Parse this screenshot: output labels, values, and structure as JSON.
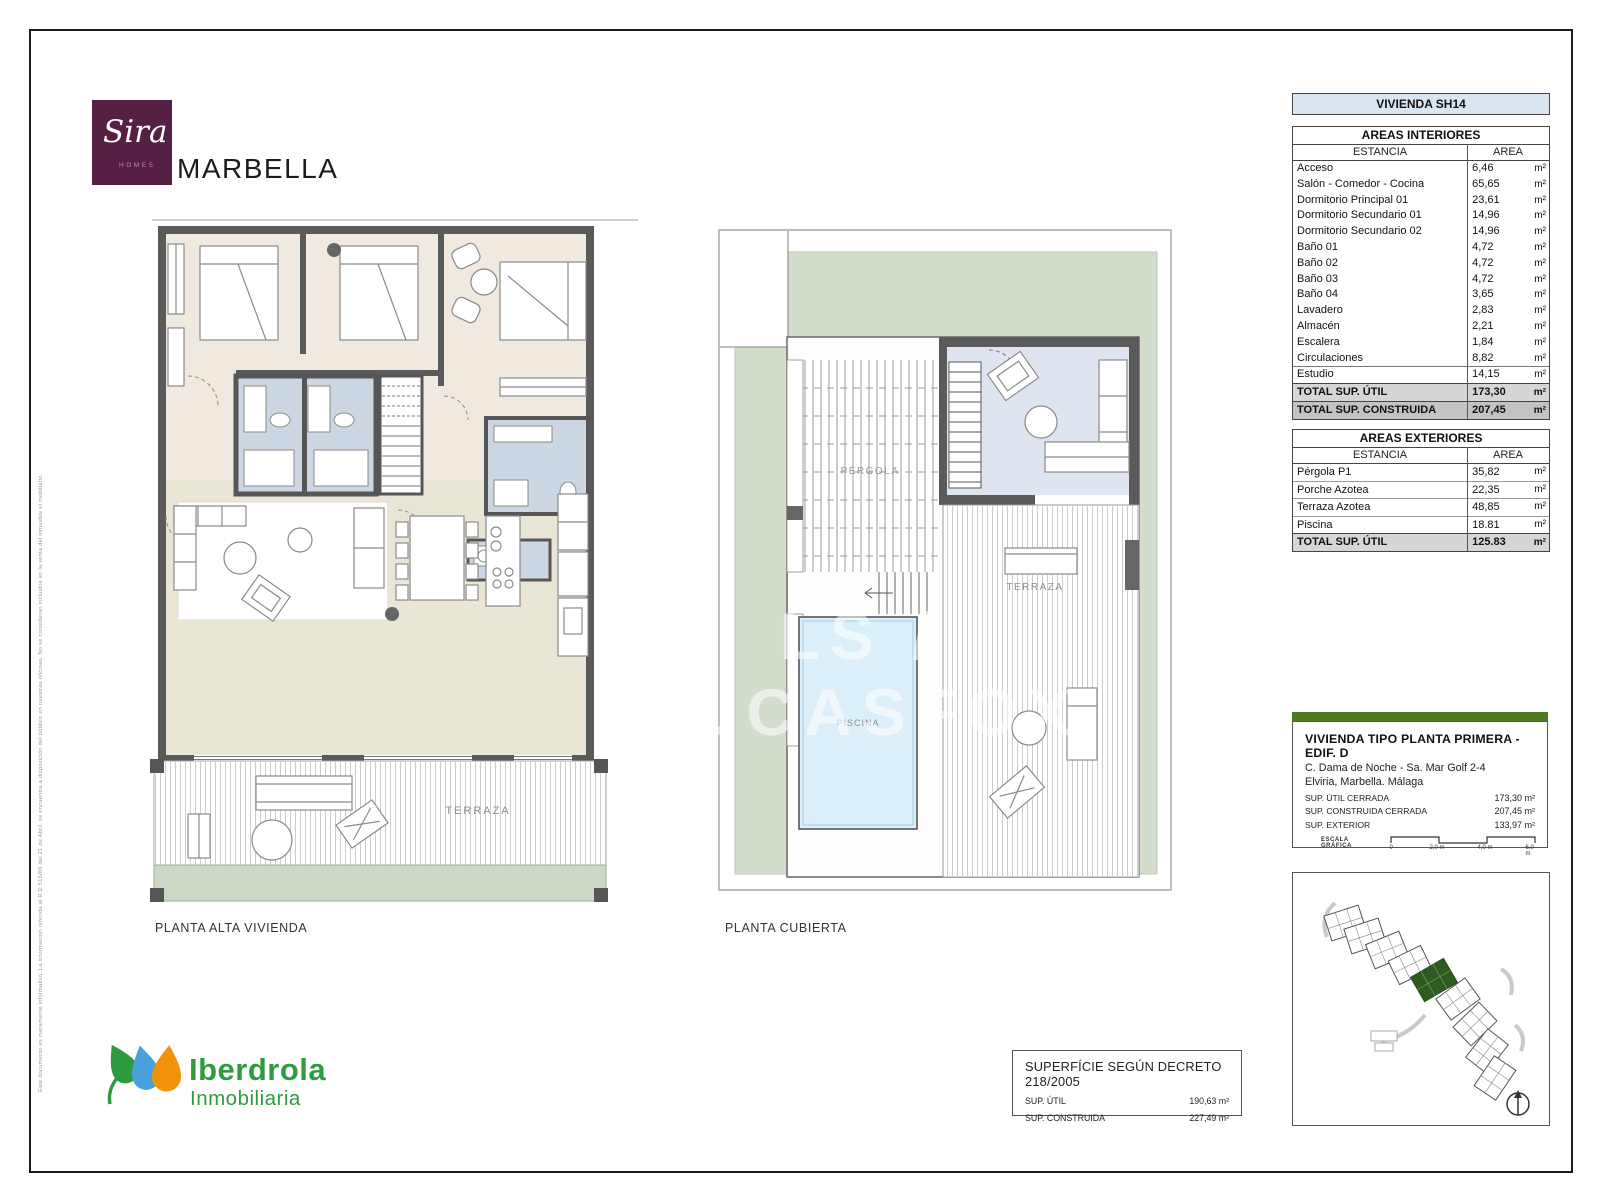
{
  "page": {
    "disclaimer": "Este documento es meramente informativo. La información referida al R.D 515/89 del 21 de Abril, se encuentra a disposición del público en nuestras oficinas. No se consideran incluidos en la venta del inmueble el mobiliario.",
    "watermark": "LS / LUCASFOX"
  },
  "brand": {
    "logo_script": "Sira",
    "logo_sub": "HOMES",
    "city": "MARBELLA"
  },
  "plans": {
    "left": {
      "label": "PLANTA ALTA VIVIENDA",
      "terrace_label": "TERRAZA"
    },
    "right": {
      "label": "PLANTA CUBIERTA",
      "pergola_label": "PÉRGOLA",
      "terrace_label": "TERRAZA",
      "pool_label": "PISCINA"
    }
  },
  "unit_header": {
    "title": "VIVIENDA SH14"
  },
  "interior_table": {
    "title": "AREAS INTERIORES",
    "col_estancia": "ESTANCIA",
    "col_area": "AREA",
    "unit": "m²",
    "rows": [
      {
        "name": "Acceso",
        "area": "6,46",
        "unit": "m²"
      },
      {
        "name": "Salón - Comedor - Cocina",
        "area": "65,65",
        "unit": "m²"
      },
      {
        "name": "Dormitorio Principal 01",
        "area": "23,61",
        "unit": "m²"
      },
      {
        "name": "Dormitorio Secundario 01",
        "area": "14,96",
        "unit": "m²"
      },
      {
        "name": "Dormitorio Secundario 02",
        "area": "14,96",
        "unit": "m²"
      },
      {
        "name": "Baño 01",
        "area": "4,72",
        "unit": "m²"
      },
      {
        "name": "Baño 02",
        "area": "4,72",
        "unit": "m²"
      },
      {
        "name": "Baño 03",
        "area": "4,72",
        "unit": "m²"
      },
      {
        "name": "Baño 04",
        "area": "3,65",
        "unit": "m²"
      },
      {
        "name": "Lavadero",
        "area": "2,83",
        "unit": "m²"
      },
      {
        "name": "Almacén",
        "area": "2,21",
        "unit": "m²"
      },
      {
        "name": "Escalera",
        "area": "1,84",
        "unit": "m²"
      },
      {
        "name": "Circulaciones",
        "area": "8,82",
        "unit": "m²"
      },
      {
        "name": "Estudio",
        "area": "14,15",
        "unit": "m²"
      }
    ],
    "totals": [
      {
        "name": "TOTAL SUP. ÚTIL",
        "area": "173,30",
        "unit": "m²"
      },
      {
        "name": "TOTAL SUP. CONSTRUIDA",
        "area": "207,45",
        "unit": "m²"
      }
    ]
  },
  "exterior_table": {
    "title": "AREAS EXTERIORES",
    "col_estancia": "ESTANCIA",
    "col_area": "AREA",
    "unit": "m²",
    "rows": [
      {
        "name": "Pérgola P1",
        "area": "35,82",
        "unit": "m²"
      },
      {
        "name": "Porche Azotea",
        "area": "22,35",
        "unit": "m²"
      },
      {
        "name": "Terraza Azotea",
        "area": "48,85",
        "unit": "m²"
      },
      {
        "name": "Piscina",
        "area": "18.81",
        "unit": "m²"
      }
    ],
    "totals": [
      {
        "name": "TOTAL SUP. ÚTIL",
        "area": "125.83",
        "unit": "m²"
      }
    ]
  },
  "info_box": {
    "title": "VIVIENDA TIPO PLANTA PRIMERA - EDIF. D",
    "address1": "C. Dama de Noche - Sa. Mar Golf 2-4",
    "address2": "Elviria, Marbella. Málaga",
    "rows": [
      {
        "label": "SUP. ÚTIL CERRADA",
        "value": "173,30 m²"
      },
      {
        "label": "SUP. CONSTRUIDA CERRADA",
        "value": "207,45 m²"
      },
      {
        "label": "SUP. EXTERIOR",
        "value": "133,97 m²"
      }
    ],
    "scale_label": "ESCALA GRÁFICA",
    "scale_ticks": [
      "0",
      "2,0 m",
      "4,0 m",
      "6,0 m"
    ]
  },
  "decreto_box": {
    "title": "SUPERFÍCIE SEGÚN DECRETO 218/2005",
    "rows": [
      {
        "label": "SUP. ÚTIL",
        "value": "190,63 m²"
      },
      {
        "label": "SUP. CONSTRUIDA",
        "value": "227,49 m²"
      }
    ]
  },
  "developer": {
    "name": "Iberdrola",
    "division": "Inmobiliaria"
  },
  "colors": {
    "plum": "#561f44",
    "head-blue": "#d9e6f2",
    "bar-green": "#4e7a23",
    "ib-green": "#2f9b3f",
    "site-green": "#2e5c20",
    "sage": "#d2ddcb",
    "pool-blue": "#dbeffa",
    "bath-blue": "#ccd7e3"
  }
}
